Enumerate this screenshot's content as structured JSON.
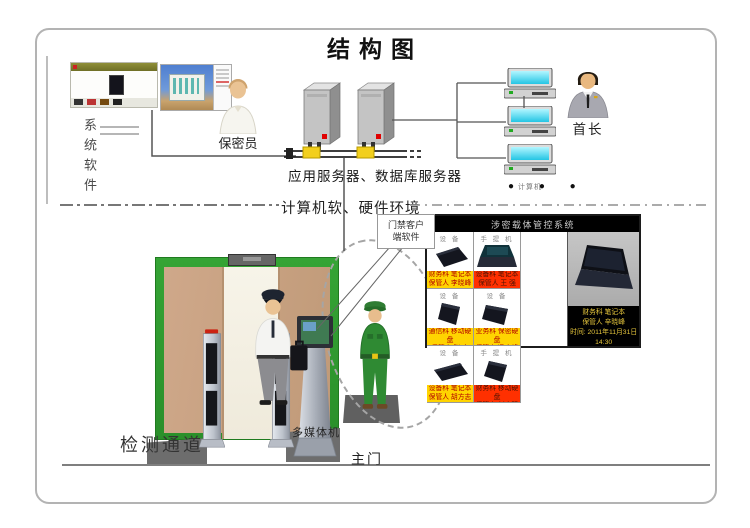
{
  "title": "结构图",
  "left": {
    "system_software_label": "系统软件"
  },
  "top": {
    "secrecy_officer_label": "保密员",
    "servers_label": "应用服务器、数据库服务器",
    "chief_label": "首长",
    "computer_labels": [
      "计算机",
      "计算机",
      "计算机"
    ],
    "more_dots": "●  ●  ●"
  },
  "divider_label": "计算机软、硬件环境",
  "bottom": {
    "client_software_line1": "门禁客户",
    "client_software_line2": "端软件",
    "channel_label": "检测通道",
    "kiosk_label": "多媒体机",
    "main_gate_label": "主门"
  },
  "panel": {
    "title": "涉密载体管控系统",
    "cells": [
      {
        "header": "设 备",
        "dept": "财务科 笔记本",
        "keeper": "保管人 李晓峰"
      },
      {
        "header": "手 提 机",
        "dept": "设备科 笔记本",
        "keeper": "保管人 王  强"
      },
      {
        "header": "设 备",
        "dept": "通信科 移动硬盘",
        "keeper": "保管人 张  杰"
      },
      {
        "header": "设 备",
        "dept": "业务科 保密硬盘",
        "keeper": "保管人 冯志峰"
      },
      {
        "header": "设 备",
        "dept": "设备科 笔记本",
        "keeper": "保管人 胡方志"
      },
      {
        "header": "手 提 机",
        "dept": "财务科 移动硬盘",
        "keeper": "保管人 刘志强"
      }
    ],
    "detail": {
      "line1": "财务科  笔记本",
      "line2": "保管人  辛晓峰",
      "line3": "时间: 2011年11月31日",
      "line4": "14:30"
    }
  },
  "colors": {
    "gate_green": "#2fa12f",
    "wall_tan": "#c9a183",
    "bar_yellow": "#ffd400",
    "bar_red": "#ff3000",
    "connector_yellow": "#f2cf1d",
    "screen_cyan": "#59e8f7",
    "soldier_green": "#2f8a33"
  }
}
